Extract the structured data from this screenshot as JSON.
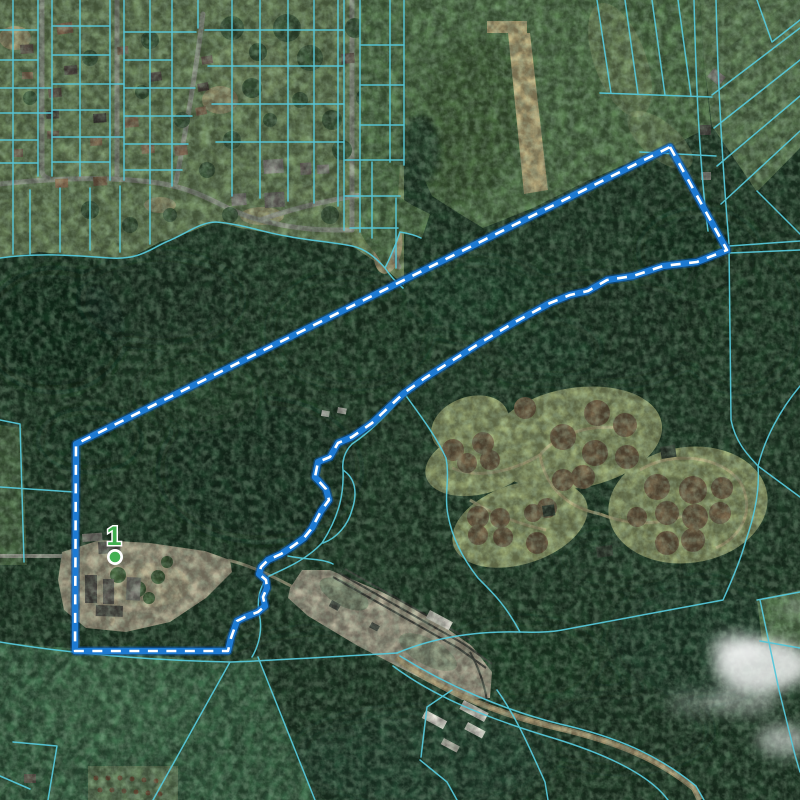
{
  "map": {
    "marker": {
      "label": "1",
      "label_color": "#3fae4e",
      "dot_fill": "#44b054",
      "dot_ring": "#ffffff",
      "cx": 115,
      "cy": 557
    },
    "highlighted_parcel": {
      "points": "670,147 727,250 697,262 663,266 633,276 607,280 588,291 570,295 550,303 515,322 480,343 450,362 425,378 404,393 390,406 372,423 352,437 338,443 330,457 318,462 315,477 326,489 329,500 321,511 312,528 304,538 293,546 281,554 268,560 261,567 259,574 266,580 267,588 263,597 265,606 258,612 245,617 237,621 231,638 228,651 75,651 76,444",
      "outline_dark_color": "#0b4f9c",
      "outline_blue_color": "#1e7ad2",
      "dash_color": "#ffffff"
    },
    "cadastral_line_color": "#56c6d8"
  }
}
